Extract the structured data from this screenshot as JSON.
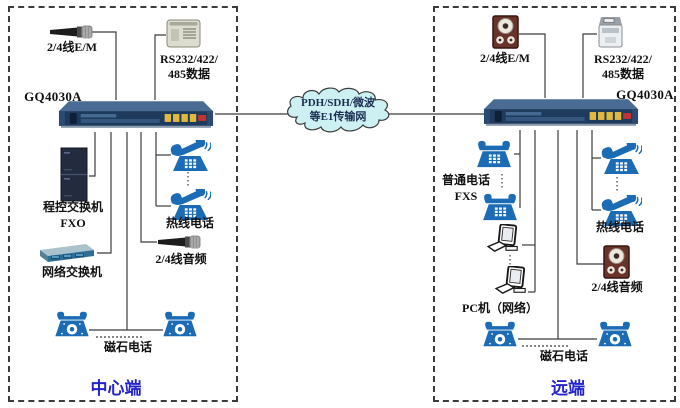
{
  "diagram": {
    "center": {
      "title": "中心端",
      "device": "GQ4030A",
      "em_audio": "2/4线E/M",
      "serial_line1": "RS232/422/",
      "serial_line2": "485数据",
      "pbx_line1": "程控交换机",
      "pbx_line2": "FXO",
      "lan_switch": "网络交换机",
      "hotline": "热线电话",
      "audio": "2/4线音频",
      "magneto": "磁石电话"
    },
    "network_cloud": {
      "line1": "PDH/SDH/微波",
      "line2": "等E1传输网"
    },
    "remote": {
      "title": "远端",
      "device": "GQ4030A",
      "em_audio": "2/4线E/M",
      "serial_line1": "RS232/422/",
      "serial_line2": "485数据",
      "fxs_line1": "普通电话",
      "fxs_line2": "FXS",
      "hotline": "热线电话",
      "audio": "2/4线音频",
      "pc": "PC机（网络）",
      "magneto": "磁石电话"
    },
    "colors": {
      "phone_blue": "#1b6cb5",
      "cloud_fill": "#cdf1f2",
      "title_blue": "#2424cc",
      "wire_gray": "#3c3c3c"
    }
  }
}
